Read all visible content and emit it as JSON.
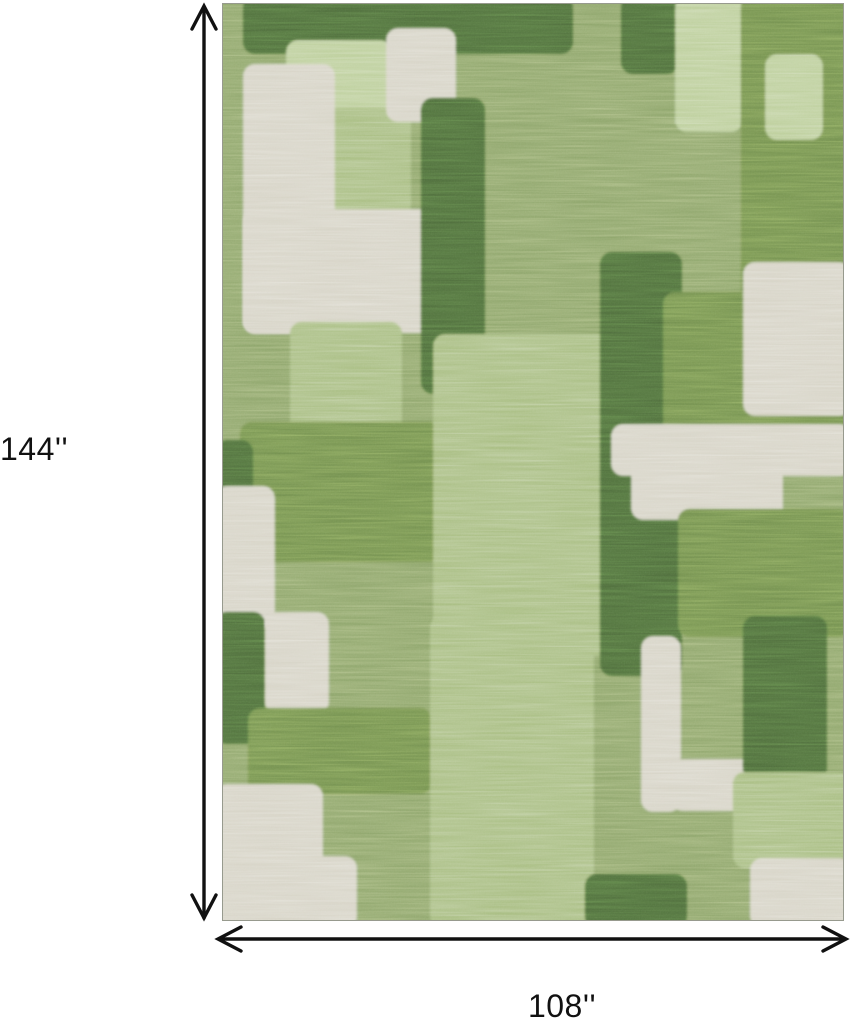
{
  "product": {
    "description": "Green abstract color-block patchwork area rug shown with dimension arrows",
    "height_label": "144''",
    "width_label": "108''"
  },
  "style": {
    "background": "#ffffff",
    "arrow_color": "#111111",
    "label_color": "#111111"
  },
  "rug": {
    "base": "med",
    "palette": {
      "cream": "#D7D4C7",
      "sage": "#BDCF9C",
      "medlight": "#A9BE83",
      "med": "#8FA66C",
      "meddark": "#74914F",
      "dark": "#4F6E3C"
    },
    "blocks": [
      {
        "x": 20,
        "y": -8,
        "w": 330,
        "h": 58,
        "c": "dark"
      },
      {
        "x": 112,
        "y": -8,
        "w": 82,
        "h": 68,
        "c": "dark"
      },
      {
        "x": 398,
        "y": -8,
        "w": 58,
        "h": 78,
        "c": "dark"
      },
      {
        "x": 452,
        "y": -8,
        "w": 68,
        "h": 136,
        "c": "sage"
      },
      {
        "x": 518,
        "y": -8,
        "w": 110,
        "h": 308,
        "c": "meddark"
      },
      {
        "x": 542,
        "y": 50,
        "w": 58,
        "h": 86,
        "c": "sage"
      },
      {
        "x": 63,
        "y": 36,
        "w": 106,
        "h": 128,
        "c": "sage"
      },
      {
        "x": 100,
        "y": 104,
        "w": 88,
        "h": 110,
        "c": "medlight"
      },
      {
        "x": 163,
        "y": 24,
        "w": 70,
        "h": 94,
        "c": "cream"
      },
      {
        "x": 20,
        "y": 60,
        "w": 92,
        "h": 270,
        "c": "cream"
      },
      {
        "x": 20,
        "y": 205,
        "w": 198,
        "h": 124,
        "c": "cream"
      },
      {
        "x": 198,
        "y": 94,
        "w": 64,
        "h": 296,
        "c": "dark"
      },
      {
        "x": 67,
        "y": 318,
        "w": 112,
        "h": 142,
        "c": "medlight"
      },
      {
        "x": 17,
        "y": 418,
        "w": 202,
        "h": 140,
        "c": "meddark"
      },
      {
        "x": -8,
        "y": 436,
        "w": 38,
        "h": 180,
        "c": "dark"
      },
      {
        "x": -8,
        "y": 482,
        "w": 60,
        "h": 142,
        "c": "cream"
      },
      {
        "x": 210,
        "y": 330,
        "w": 178,
        "h": 322,
        "c": "medlight"
      },
      {
        "x": 377,
        "y": 248,
        "w": 82,
        "h": 424,
        "c": "dark"
      },
      {
        "x": 440,
        "y": 288,
        "w": 182,
        "h": 158,
        "c": "meddark"
      },
      {
        "x": 520,
        "y": 258,
        "w": 108,
        "h": 154,
        "c": "cream"
      },
      {
        "x": 388,
        "y": 420,
        "w": 240,
        "h": 52,
        "c": "cream"
      },
      {
        "x": 408,
        "y": 452,
        "w": 152,
        "h": 64,
        "c": "cream"
      },
      {
        "x": 455,
        "y": 505,
        "w": 173,
        "h": 128,
        "c": "meddark"
      },
      {
        "x": -8,
        "y": 608,
        "w": 50,
        "h": 132,
        "c": "dark"
      },
      {
        "x": 42,
        "y": 608,
        "w": 64,
        "h": 102,
        "c": "cream"
      },
      {
        "x": 25,
        "y": 704,
        "w": 184,
        "h": 86,
        "c": "meddark"
      },
      {
        "x": 207,
        "y": 612,
        "w": 164,
        "h": 312,
        "c": "medlight"
      },
      {
        "x": 418,
        "y": 632,
        "w": 40,
        "h": 176,
        "c": "cream"
      },
      {
        "x": 448,
        "y": 755,
        "w": 92,
        "h": 52,
        "c": "cream"
      },
      {
        "x": 520,
        "y": 612,
        "w": 84,
        "h": 164,
        "c": "dark"
      },
      {
        "x": 510,
        "y": 768,
        "w": 118,
        "h": 96,
        "c": "medlight"
      },
      {
        "x": 527,
        "y": 854,
        "w": 101,
        "h": 70,
        "c": "cream"
      },
      {
        "x": -8,
        "y": 780,
        "w": 108,
        "h": 144,
        "c": "cream"
      },
      {
        "x": -8,
        "y": 852,
        "w": 142,
        "h": 72,
        "c": "cream"
      },
      {
        "x": 362,
        "y": 870,
        "w": 102,
        "h": 54,
        "c": "dark"
      }
    ]
  }
}
